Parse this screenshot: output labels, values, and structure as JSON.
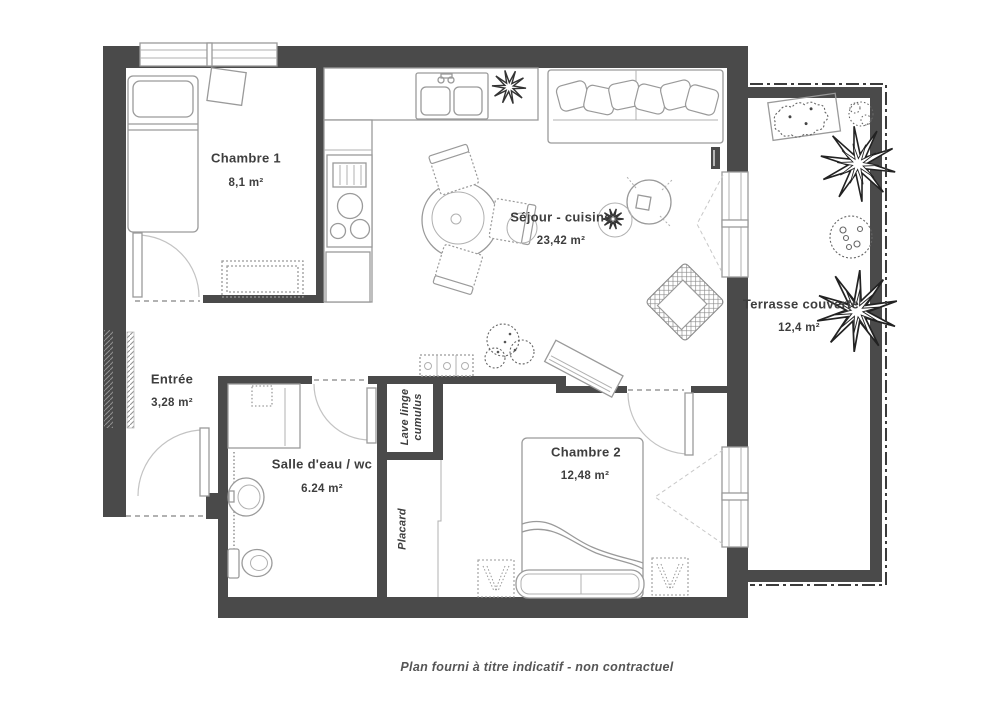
{
  "plan": {
    "caption": "Plan fourni à titre indicatif - non contractuel",
    "rooms": {
      "chambre1": {
        "name": "Chambre 1",
        "area": "8,1 m²"
      },
      "sejour": {
        "name": "Séjour - cuisine",
        "area": "23,42 m²"
      },
      "terrasse": {
        "name": "Terrasse couverte",
        "area": "12,4 m²"
      },
      "entree": {
        "name": "Entrée",
        "area": "3,28 m²"
      },
      "salle_eau": {
        "name": "Salle d'eau / wc",
        "area": "6.24 m²"
      },
      "chambre2": {
        "name": "Chambre 2",
        "area": "12,48 m²"
      },
      "lave_linge": {
        "line1": "Lave linge",
        "line2": "cumulus"
      },
      "placard": {
        "name": "Placard"
      }
    },
    "colors": {
      "wall": "#4a4a4a",
      "furniture_line": "#9a9a9a",
      "plant_line": "#222222",
      "text": "#3e3e3e"
    }
  }
}
